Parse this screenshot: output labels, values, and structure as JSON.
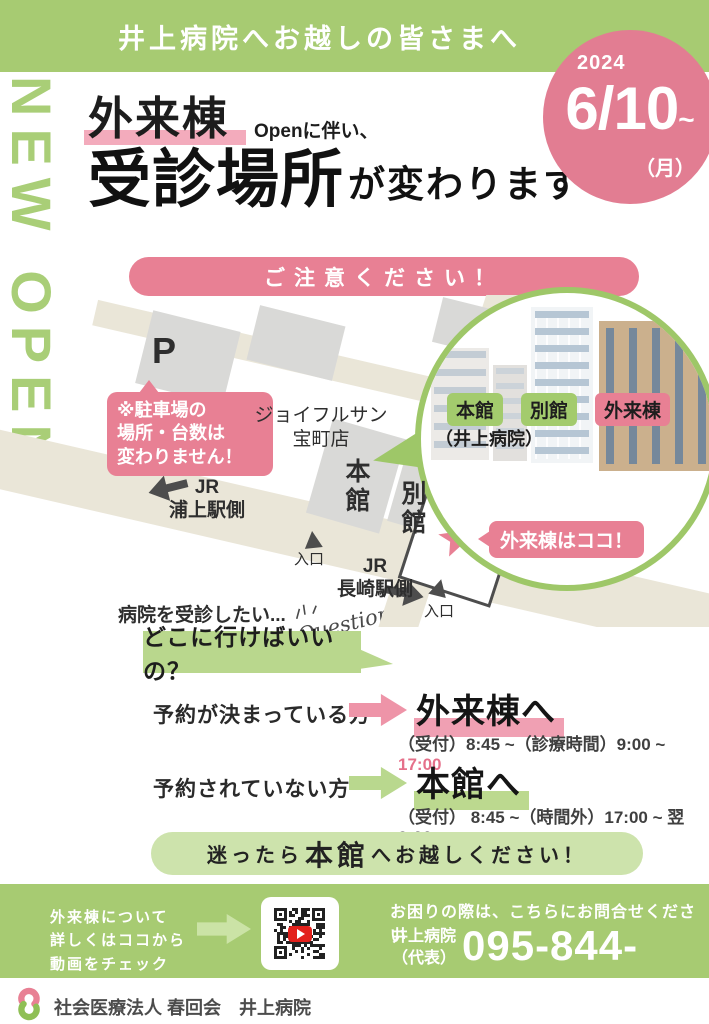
{
  "colors": {
    "green": "#a7cb72",
    "green_light": "#cde3ac",
    "green_box": "#b9d78d",
    "green_badge": "#a3cb6d",
    "pink": "#e88094",
    "pink_circle": "#e27d92",
    "pink_marker": "#f0a0b3",
    "map_road": "#eae6d8",
    "map_block": "#d9d9d7",
    "youtube_red": "#e3201b"
  },
  "header": {
    "banner": "井上病院へお越しの皆さまへ",
    "vertical_label": "NEW OPEN",
    "date_year": "2024",
    "date_day": "6/10",
    "date_tilde": "~",
    "date_weekday": "（月）"
  },
  "title": {
    "highlight": "外来棟",
    "note": "Openに伴い、",
    "main": "受診場所",
    "tail": "が変わります"
  },
  "caution_banner": "ご注意ください！",
  "map": {
    "parking_mark": "P",
    "parking_note": "※駐車場の\n場所・台数は\n変わりません！",
    "store": "ジョイフルサン\n宝町店",
    "building_main": "本\n館",
    "building_annex": "別\n館",
    "jr_urakami": "JR\n浦上駅側",
    "jr_nagasaki": "JR\n長崎駅側",
    "entrance1": "入口",
    "entrance2": "入口",
    "outpatient_callout": "外来棟はココ！",
    "photo": {
      "main": "本館",
      "annex": "別館",
      "outpatient": "外来棟",
      "hospital": "（井上病院）"
    }
  },
  "question": {
    "lead": "病院を受診したい...",
    "doodle": "Question",
    "box": "どこに行けばいいの？"
  },
  "guide": [
    {
      "condition": "予約が決まっている方",
      "destination": "外来棟へ",
      "detail": "（受付）8:45 ~（診療時間）9:00 ~ ",
      "detail_highlight": "17:00"
    },
    {
      "condition": "予約されていない方",
      "destination": "本館へ",
      "detail": "（受付） 8:45 ~（時間外）17:00 ~ 翌9:00",
      "detail_highlight": ""
    }
  ],
  "bottom_banner": {
    "pre": "迷ったら",
    "strong": "本館",
    "post": "へお越しください！"
  },
  "contact": {
    "video_note": "外来棟について\n詳しくはココから\n動画をチェック",
    "help": "お困りの際は、こちらにお問合せください",
    "org_name": "井上病院",
    "org_sub": "（代表）",
    "phone": "095-844-1281"
  },
  "footer": {
    "company": "社会医療法人 春回会　井上病院"
  }
}
